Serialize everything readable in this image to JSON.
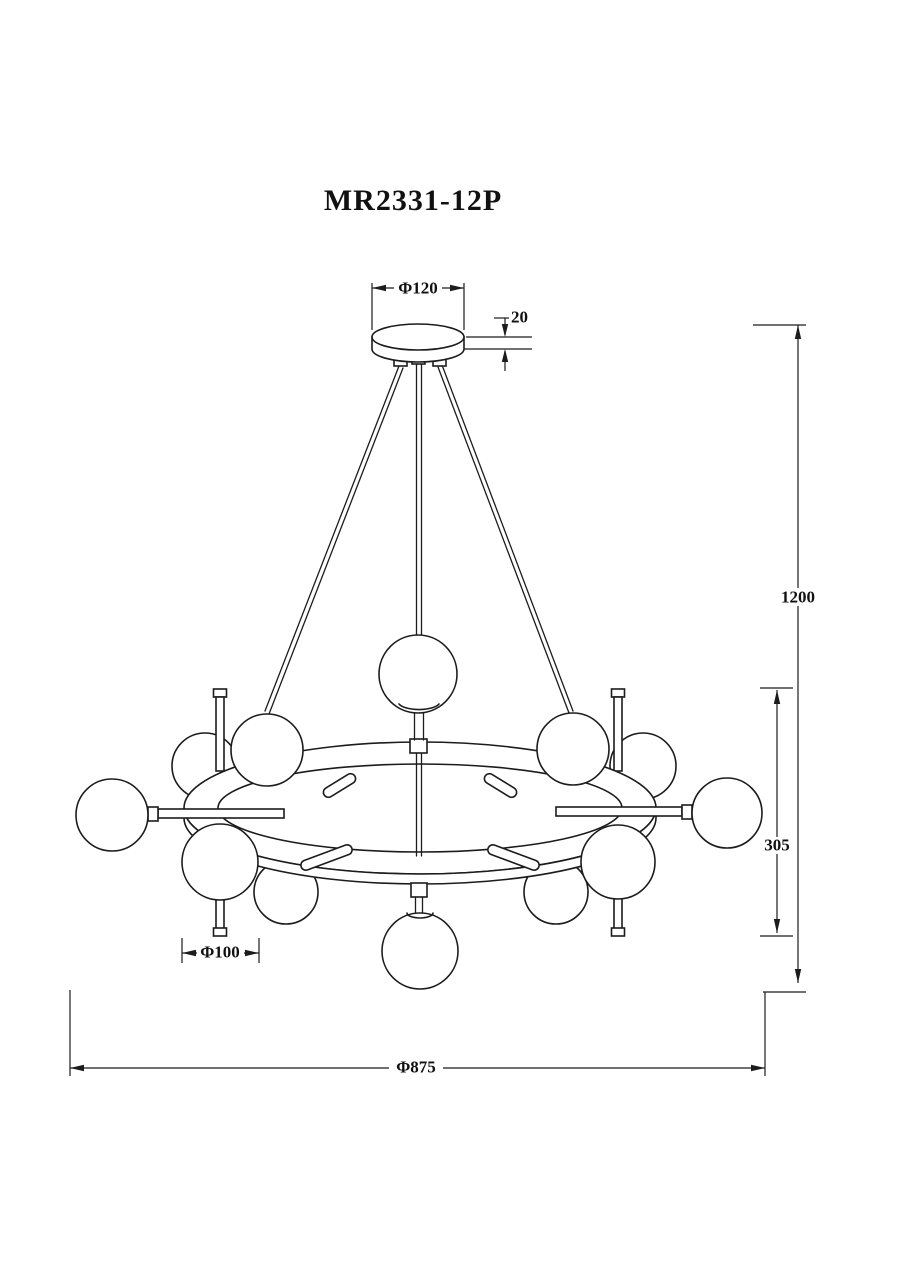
{
  "drawing": {
    "model_number": "MR2331-12P"
  },
  "dimensions": {
    "canopy_diameter": "Φ120",
    "canopy_thickness": "20",
    "suspension_height": "1200",
    "body_height": "305",
    "globe_diameter": "Φ100",
    "overall_diameter": "Φ875"
  },
  "colors": {
    "line": "#1c1c1c",
    "background": "#ffffff"
  }
}
